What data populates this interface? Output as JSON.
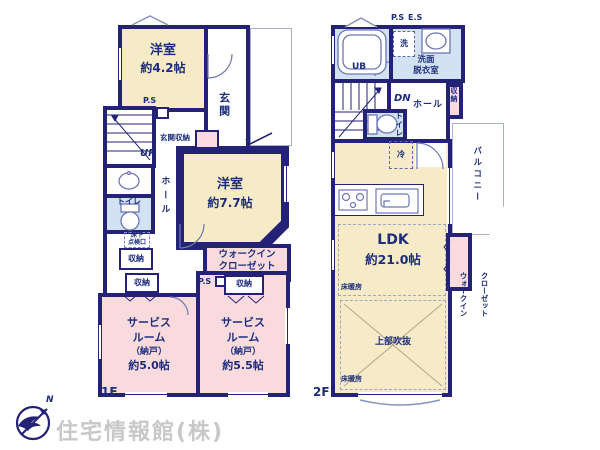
{
  "watermark": "住宅情報館(株)",
  "compass_north": "N",
  "colors": {
    "wall": "#232276",
    "room_cream": "#f6ebc6",
    "room_pink": "#f9dbde",
    "room_blue": "#d3e2f2",
    "label_text": "#1c2d7c",
    "watermark_gray": "#c8c8c8"
  },
  "shared": {
    "shuno": "収納",
    "ps": "P.S",
    "hall": "ホール",
    "toilet": "トイレ",
    "wic_top": "ウォークイン",
    "wic_bottom": "クローゼット",
    "yukadan": "床暖房",
    "yoshitsu": "洋室"
  },
  "floor1": {
    "label": "1F",
    "room42_size": "約4.2帖",
    "genkan": "玄関",
    "genkan_shuno": "玄関収納",
    "up": "UP",
    "room77_size": "約7.7帖",
    "yukashita_1": "床下",
    "yukashita_2": "点検口",
    "service50": {
      "name1": "サービス",
      "name2": "ルーム",
      "name3": "（納戸）",
      "size": "約5.0帖"
    },
    "service55": {
      "name1": "サービス",
      "name2": "ルーム",
      "name3": "（納戸）",
      "size": "約5.5帖"
    }
  },
  "floor2": {
    "label": "2F",
    "ps": "P.S",
    "es": "E.S",
    "ub": "UB",
    "washer": "洗",
    "senmen_1": "洗面",
    "senmen_2": "脱衣室",
    "dn": "DN",
    "rei": "冷",
    "ldk_name": "LDK",
    "ldk_size": "約21.0帖",
    "fukinuke": "上部吹抜",
    "balcony": "バルコニー"
  }
}
